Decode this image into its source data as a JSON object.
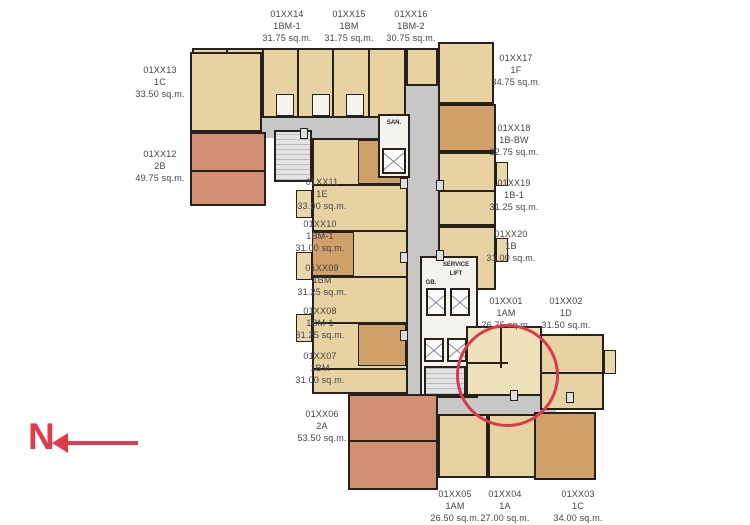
{
  "document": {
    "kind": "residential floor plan",
    "highlighted_unit": "01XX01"
  },
  "north": {
    "label": "N"
  },
  "core": {
    "service": "SERVICE",
    "lift": "LIFT",
    "gb": "GB.",
    "san": "SAN."
  },
  "units": [
    {
      "id": "01XX14",
      "type": "1BM-1",
      "area": "31.75 sq.m."
    },
    {
      "id": "01XX15",
      "type": "1BM",
      "area": "31.75 sq.m."
    },
    {
      "id": "01XX16",
      "type": "1BM-2",
      "area": "30.75 sq.m."
    },
    {
      "id": "01XX17",
      "type": "1F",
      "area": "34.75 sq.m."
    },
    {
      "id": "01XX13",
      "type": "1C",
      "area": "33.50 sq.m."
    },
    {
      "id": "01XX18",
      "type": "1B-BW",
      "area": "32.75 sq.m."
    },
    {
      "id": "01XX12",
      "type": "2B",
      "area": "49.75 sq.m."
    },
    {
      "id": "01XX11",
      "type": "1E",
      "area": "33.00 sq.m."
    },
    {
      "id": "01XX19",
      "type": "1B-1",
      "area": "31.25 sq.m."
    },
    {
      "id": "01XX10",
      "type": "1BM-1",
      "area": "31.00 sq.m."
    },
    {
      "id": "01XX20",
      "type": "1B",
      "area": "31.00 sq.m."
    },
    {
      "id": "01XX09",
      "type": "1BM",
      "area": "31.25 sq.m."
    },
    {
      "id": "01XX01",
      "type": "1AM",
      "area": "26.75 sq.m."
    },
    {
      "id": "01XX02",
      "type": "1D",
      "area": "31.50 sq.m."
    },
    {
      "id": "01XX08",
      "type": "1BM-1",
      "area": "31.25 sq.m."
    },
    {
      "id": "01XX07",
      "type": "1BM",
      "area": "31.00 sq.m."
    },
    {
      "id": "01XX06",
      "type": "2A",
      "area": "53.50 sq.m."
    },
    {
      "id": "01XX05",
      "type": "1AM",
      "area": "26.50 sq.m."
    },
    {
      "id": "01XX04",
      "type": "1A",
      "area": "27.00 sq.m."
    },
    {
      "id": "01XX03",
      "type": "1C",
      "area": "34.00 sq.m."
    }
  ],
  "palette": {
    "unit_tan": "#e7d3a2",
    "unit_brown": "#cfa06a",
    "unit_salmon": "#d18f74",
    "corridor_gray": "#c7c7c7",
    "wall_black": "#26211b",
    "label_text": "#43434c",
    "highlight_red": "#dc3a4b",
    "north_red": "#e23b4e"
  }
}
